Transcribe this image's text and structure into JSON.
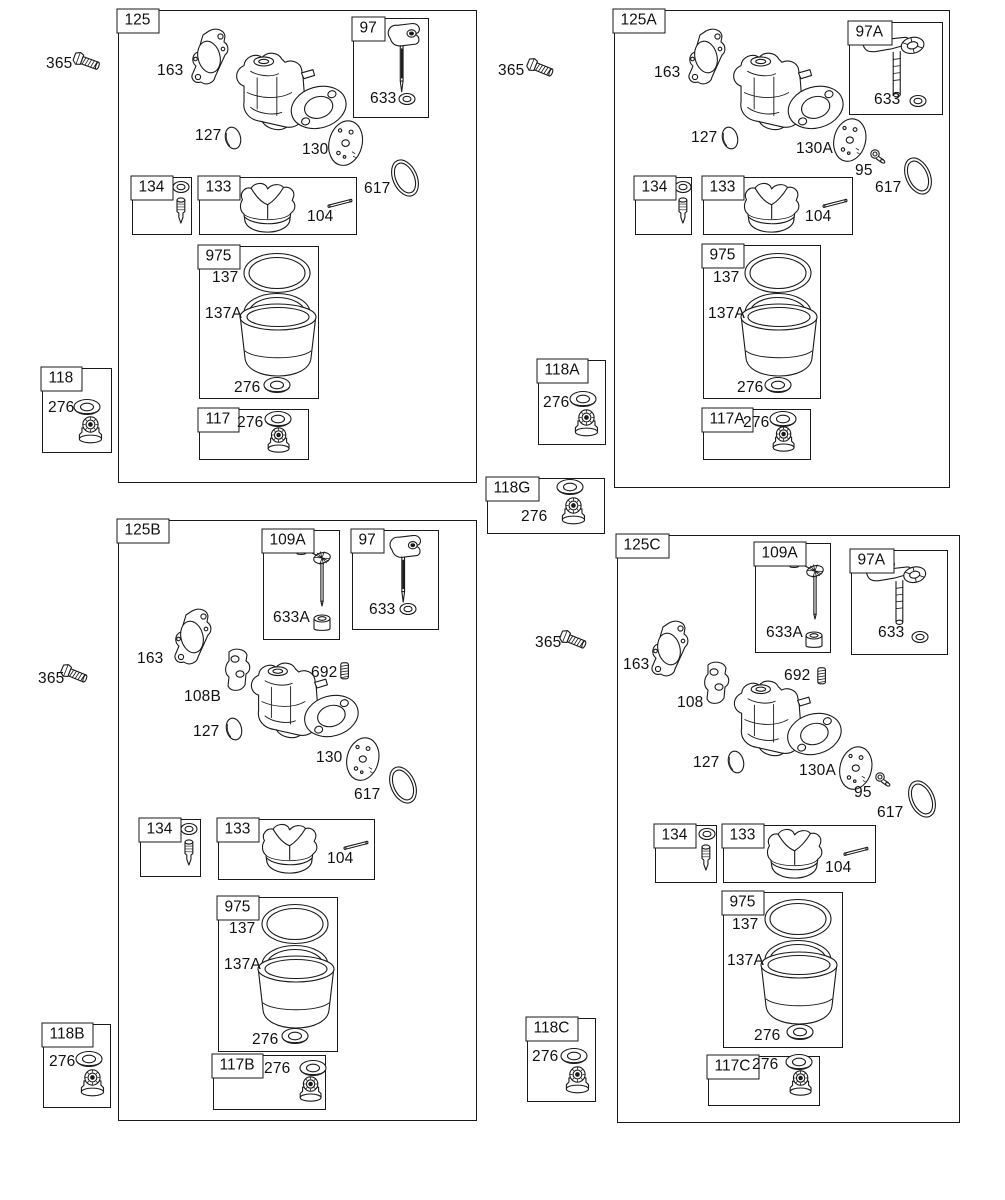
{
  "diagram": {
    "subject": "Carburetor exploded parts diagram with four assembly variants",
    "background": "#ffffff",
    "line_color": "#1a1a1a"
  },
  "box_labels": {
    "b125": "125",
    "b125A": "125A",
    "b125B": "125B",
    "b125C": "125C",
    "b97": "97",
    "b97A": "97A",
    "b109A": "109A",
    "b133": "133",
    "b134": "134",
    "b975": "975",
    "b117": "117",
    "b117A": "117A",
    "b117B": "117B",
    "b117C": "117C",
    "b118": "118",
    "b118A": "118A",
    "b118B": "118B",
    "b118C": "118C",
    "b118G": "118G"
  },
  "part_labels": {
    "p95": "95",
    "p104": "104",
    "p108": "108",
    "p108B": "108B",
    "p127": "127",
    "p130": "130",
    "p130A": "130A",
    "p137": "137",
    "p137A": "137A",
    "p163": "163",
    "p276": "276",
    "p365": "365",
    "p617": "617",
    "p633": "633",
    "p633A": "633A",
    "p692": "692"
  },
  "icons": {
    "carburetor-body-icon": "carburetor body assembly",
    "gasket-icon": "mounting gasket",
    "throttle-plate-icon": "perforated round plate",
    "o-ring-icon": "O-ring seal",
    "oval-seal-icon": "small oval seal",
    "float-icon": "carburetor float",
    "float-pin-icon": "float hinge pin",
    "float-needle-icon": "float needle valve",
    "small-washer-icon": "small sealing washer",
    "flat-washer-icon": "flat sealing washer",
    "bowl-icon": "float bowl",
    "bowl-ring-icon": "bowl sealing ring",
    "bowl-bolt-icon": "bowl retaining bolt",
    "needle-valve-icon": "needle valve with paddle",
    "choke-needle-icon": "needle valve with perforated plate",
    "idle-needle-icon": "idle mixture needle",
    "cup-icon": "needle seat cup",
    "spring-icon": "coil spring",
    "screw-icon": "small screw",
    "bracket-icon": "spacer plate with holes",
    "mounting-bolt-icon": "hex mounting bolt"
  }
}
